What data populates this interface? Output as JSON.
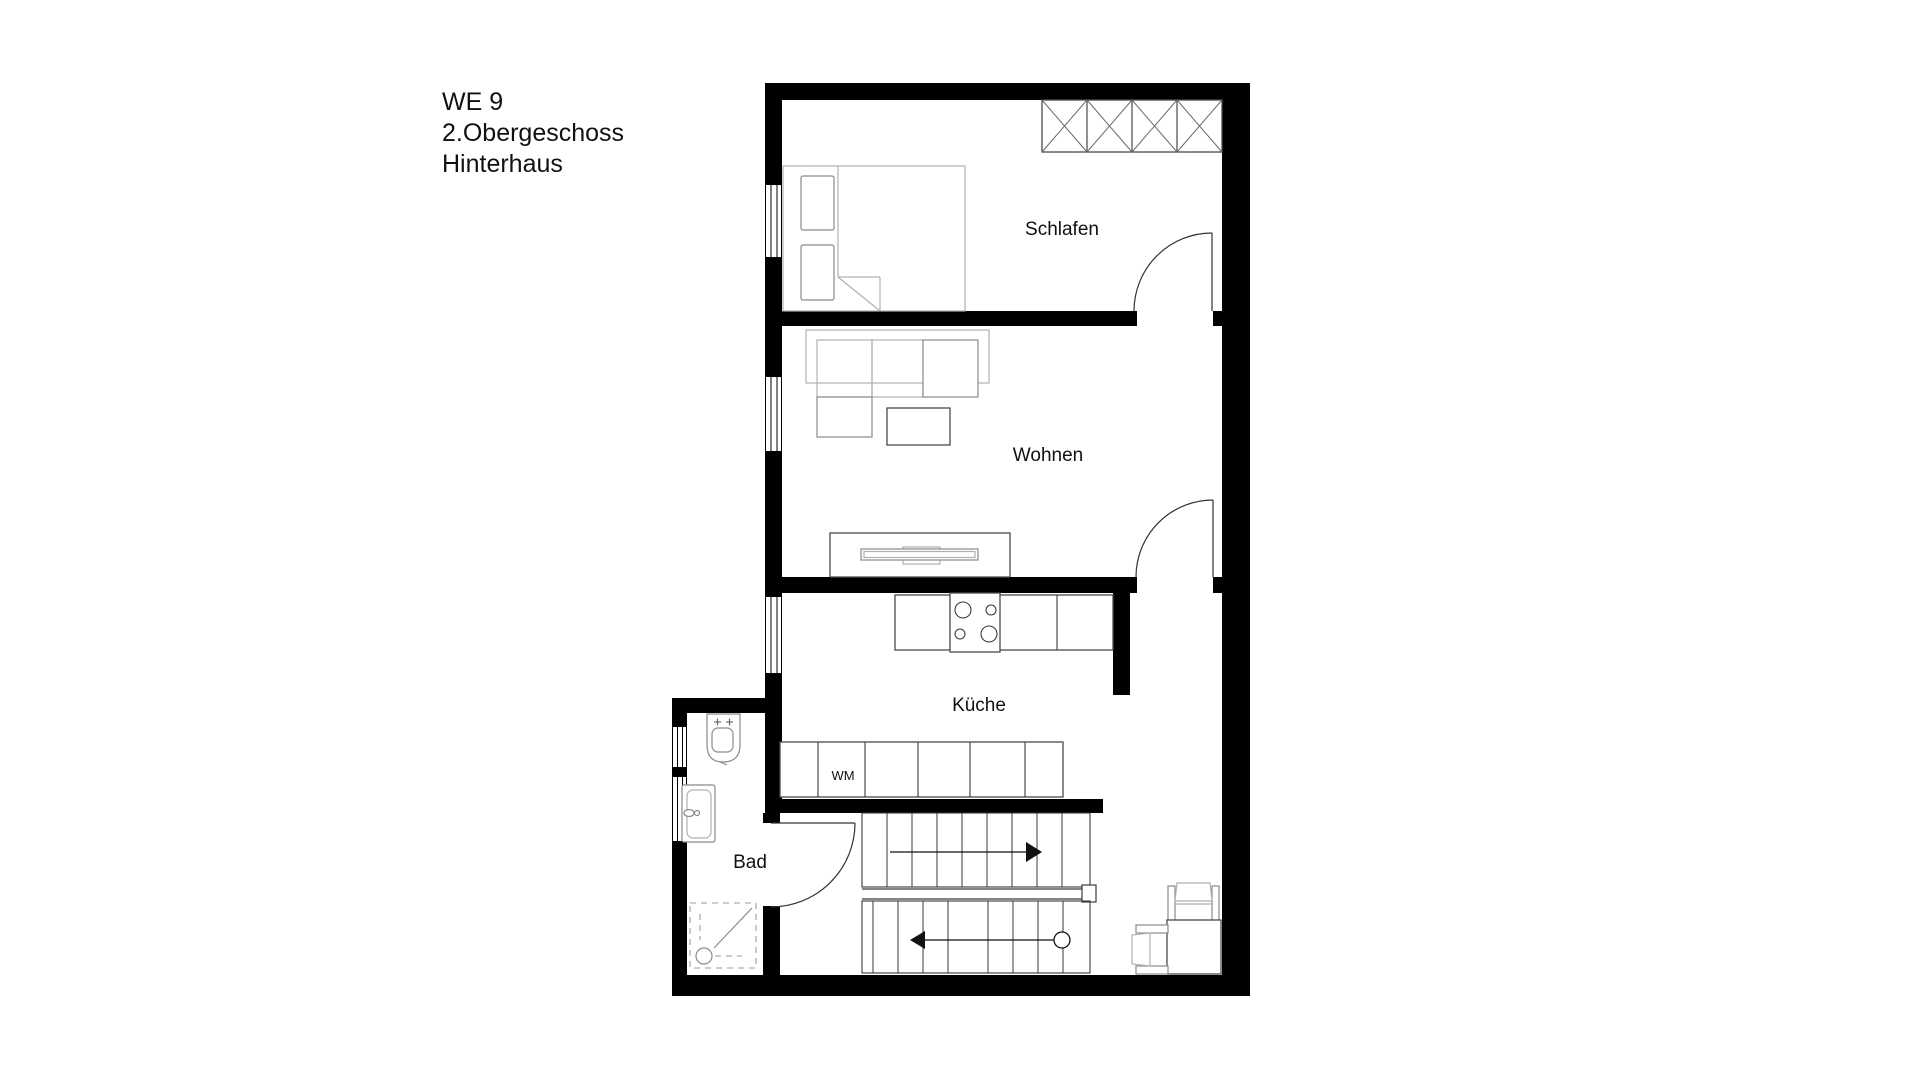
{
  "title": {
    "line1": "WE 9",
    "line2": "2.Obergeschoss",
    "line3": "Hinterhaus"
  },
  "rooms": {
    "schlafen": "Schlafen",
    "wohnen": "Wohnen",
    "kueche": "Küche",
    "bad": "Bad"
  },
  "appliances": {
    "washing_machine": "WM"
  },
  "colors": {
    "background": "#ffffff",
    "wall": "#000000",
    "text": "#111111",
    "furniture_light": "#b0b0b0",
    "furniture_mid": "#8a8a8a",
    "furniture_dark": "#4a4a4a",
    "stair_line": "#3a3a3a",
    "door_line": "#333333"
  }
}
